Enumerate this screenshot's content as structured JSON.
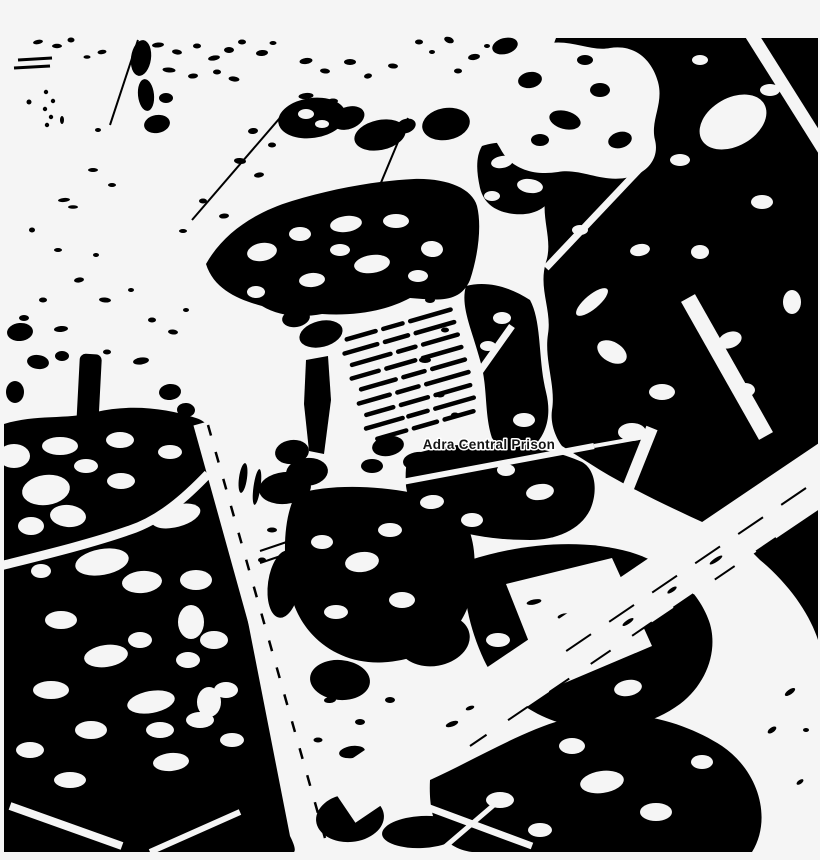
{
  "map": {
    "label": {
      "text": "Adra Central Prison",
      "text_color": "#151515",
      "halo_color": "#ffffff"
    },
    "colors": {
      "background": "#f5f5f5",
      "ink": "#000000"
    }
  }
}
